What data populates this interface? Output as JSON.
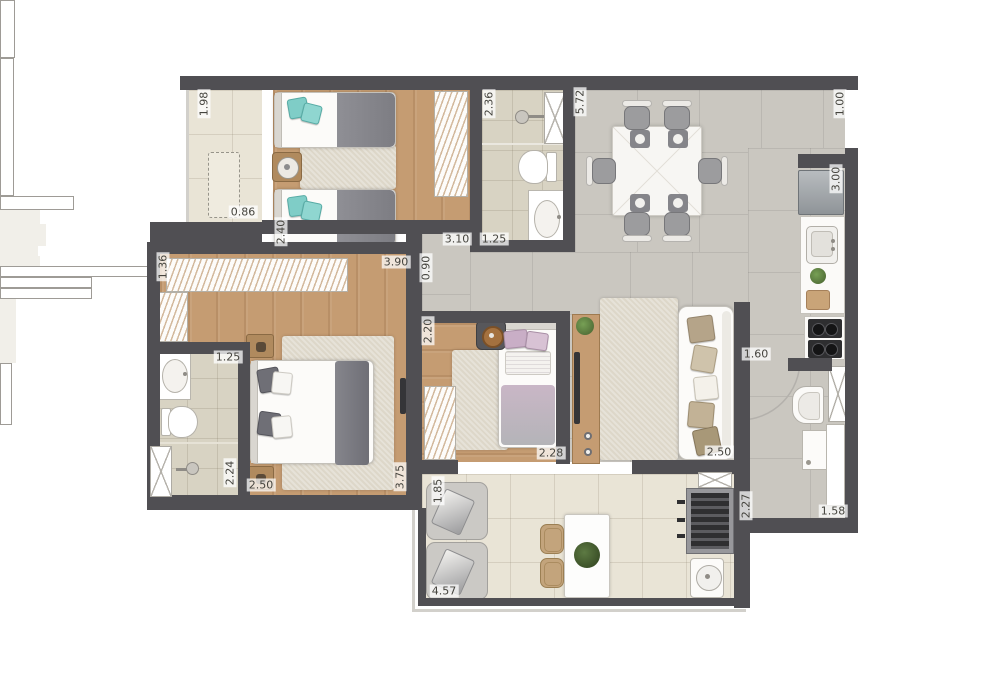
{
  "canvas": {
    "width": 1000,
    "height": 692,
    "background": "#ffffff"
  },
  "palette": {
    "wall": "#504f53",
    "wood_floor": "#c59c72",
    "tile_gray": "#cac7c0",
    "tile_cream": "#e9e4d6",
    "tile_bath": "#d8d3c3",
    "rug": "#ddd7c9",
    "accent_teal": "#7fcdc7",
    "accent_lilac": "#c9aec6",
    "blanket_gray": "#82828a",
    "counter_wood": "#b08a5e",
    "label_color": "#45443e"
  },
  "dims": [
    "1.98",
    "0.86",
    "2.40",
    "3.10",
    "1.25",
    "2.36",
    "5.72",
    "1.00",
    "3.00",
    "3.90",
    "0.90",
    "1.36",
    "1.25",
    "2.20",
    "1.60",
    "2.24",
    "2.50",
    "3.75",
    "2.28",
    "2.50",
    "1.85",
    "4.57",
    "2.27",
    "1.58"
  ],
  "rooms": [
    {
      "id": "small-balcony",
      "furniture": [
        "bench-dashed"
      ]
    },
    {
      "id": "bedroom-twin",
      "furniture": [
        "twin-bed",
        "twin-bed",
        "round-nightstand",
        "rug",
        "wardrobe"
      ]
    },
    {
      "id": "bathroom-social",
      "furniture": [
        "shower-head",
        "linen-cabinet",
        "toilet",
        "sink-counter"
      ]
    },
    {
      "id": "dining-room",
      "furniture": [
        "dining-table",
        "chair",
        "chair",
        "chair",
        "chair",
        "chair",
        "chair",
        "placemat",
        "placemat",
        "placemat",
        "placemat"
      ]
    },
    {
      "id": "kitchen",
      "furniture": [
        "refrigerator",
        "kitchen-sink",
        "plant",
        "cutting-board",
        "cooktop"
      ]
    },
    {
      "id": "service-area",
      "furniture": [
        "tall-cabinet",
        "laundry-tub",
        "washing-machine",
        "cabinet-strip"
      ]
    },
    {
      "id": "living-room",
      "furniture": [
        "sofa",
        "rug",
        "tv-rack",
        "tv",
        "plant",
        "entry-door"
      ]
    },
    {
      "id": "hallway",
      "furniture": []
    },
    {
      "id": "master-bedroom",
      "furniture": [
        "closet",
        "closet",
        "double-bed",
        "nightstand",
        "nightstand",
        "rug",
        "tv"
      ]
    },
    {
      "id": "bathroom-ensuite",
      "furniture": [
        "sink-counter",
        "toilet",
        "shower-head",
        "glass-cabinet"
      ]
    },
    {
      "id": "bedroom-single",
      "furniture": [
        "single-bed",
        "round-side-table",
        "wardrobe",
        "rug"
      ]
    },
    {
      "id": "terrace",
      "furniture": [
        "lounge-chair",
        "lounge-chair",
        "terrace-table",
        "wicker-chair",
        "wicker-chair",
        "plant",
        "grill",
        "round-sink",
        "shelf"
      ]
    }
  ]
}
